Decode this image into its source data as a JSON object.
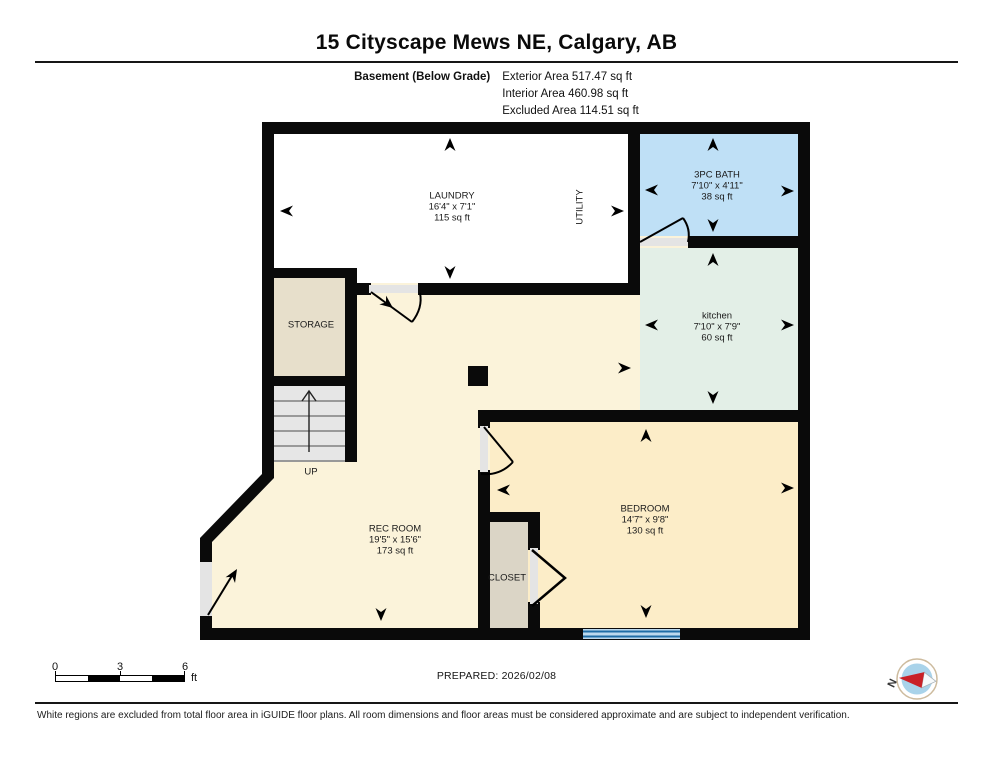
{
  "header": {
    "title": "15 Cityscape Mews NE, Calgary, AB",
    "floor_name": "Basement (Below Grade)",
    "area_lines": [
      "Exterior Area 517.47 sq ft",
      "Interior Area 460.98 sq ft",
      "Excluded Area 114.51 sq ft"
    ]
  },
  "rooms": {
    "laundry": {
      "name": "LAUNDRY",
      "dims": "16'4\" x 7'1\"",
      "area": "115 sq ft"
    },
    "utility": {
      "name": "UTILITY"
    },
    "bath": {
      "name": "3PC BATH",
      "dims": "7'10\" x 4'11\"",
      "area": "38 sq ft"
    },
    "kitchen": {
      "name": "kitchen",
      "dims": "7'10\" x 7'9\"",
      "area": "60 sq ft"
    },
    "storage": {
      "name": "STORAGE"
    },
    "stairs": {
      "label": "UP"
    },
    "rec_room": {
      "name": "REC ROOM",
      "dims": "19'5\" x 15'6\"",
      "area": "173 sq ft"
    },
    "closet": {
      "name": "CLOSET"
    },
    "bedroom": {
      "name": "BEDROOM",
      "dims": "14'7\" x 9'8\"",
      "area": "130 sq ft"
    }
  },
  "scale_bar": {
    "ticks": [
      "0",
      "3",
      "6"
    ],
    "unit": "ft"
  },
  "footer": {
    "prepared": "PREPARED: 2026/02/08",
    "north_label": "N",
    "disclaimer": "White regions are excluded from total floor area in iGUIDE floor plans. All room dimensions and floor areas must be considered approximate and are subject to independent verification."
  },
  "colors": {
    "laundry": "#ffffff",
    "bath": "#bfe0f6",
    "kitchen": "#e3efe7",
    "rec_room": "#fbf3da",
    "bedroom": "#fcedc8",
    "storage": "#e7dfcb",
    "closet": "#dbd5c6",
    "stairs": "#e6e6e6",
    "threshold": "#e4e4e4",
    "window_fill": "#bcd9ee",
    "window_line": "#1f6da6",
    "wall": "#0a0a0a",
    "compass_red": "#c92127",
    "compass_blue": "#a9d3ea"
  }
}
